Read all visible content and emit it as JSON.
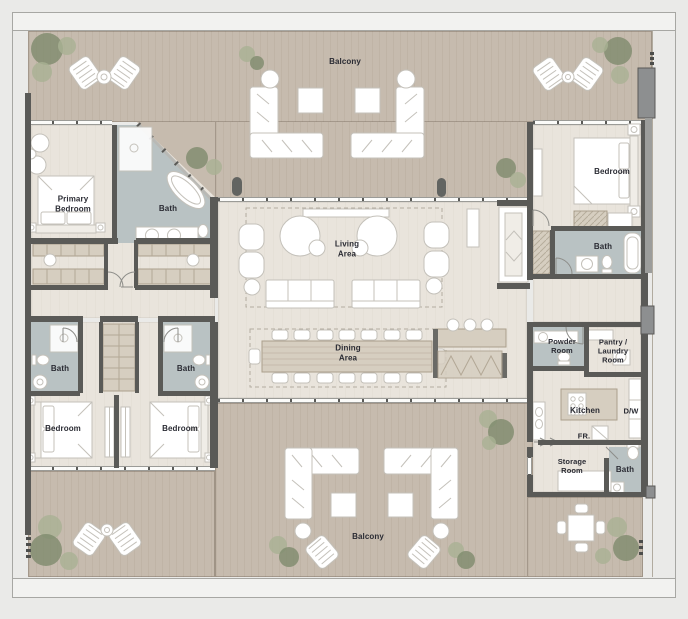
{
  "colors": {
    "background": "#eaeae8",
    "band": "#f2f2f0",
    "deck": "#c6bbae",
    "floor": "#e9e4dc",
    "bath": "#b9c2c3",
    "wall": "#5a5a57",
    "cabinet": "#d6cec0",
    "tree_dark": "#7e8b6d",
    "tree_light": "#a9b194",
    "label": "#2a2b33",
    "furniture_stroke": "#c4c1ba"
  },
  "rooms": {
    "balcony_top": "Balcony",
    "primary_bedroom": "Primary\nBedroom",
    "primary_bath": "Bath",
    "living_area": "Living\nArea",
    "dining_area": "Dining\nArea",
    "bedroom_right": "Bedroom",
    "bath_right": "Bath",
    "bath_left_1": "Bath",
    "bath_left_2": "Bath",
    "bedroom_left_1": "Bedroom",
    "bedroom_left_2": "Bedroom",
    "powder_room": "Powder\nRoom",
    "pantry_laundry": "Pantry /\nLaundry\nRoom",
    "kitchen": "Kitchen",
    "dishwasher": "D/W",
    "fridge": "FR.",
    "storage_room": "Storage\nRoom",
    "bath_bottom_right": "Bath",
    "balcony_bottom": "Balcony"
  }
}
